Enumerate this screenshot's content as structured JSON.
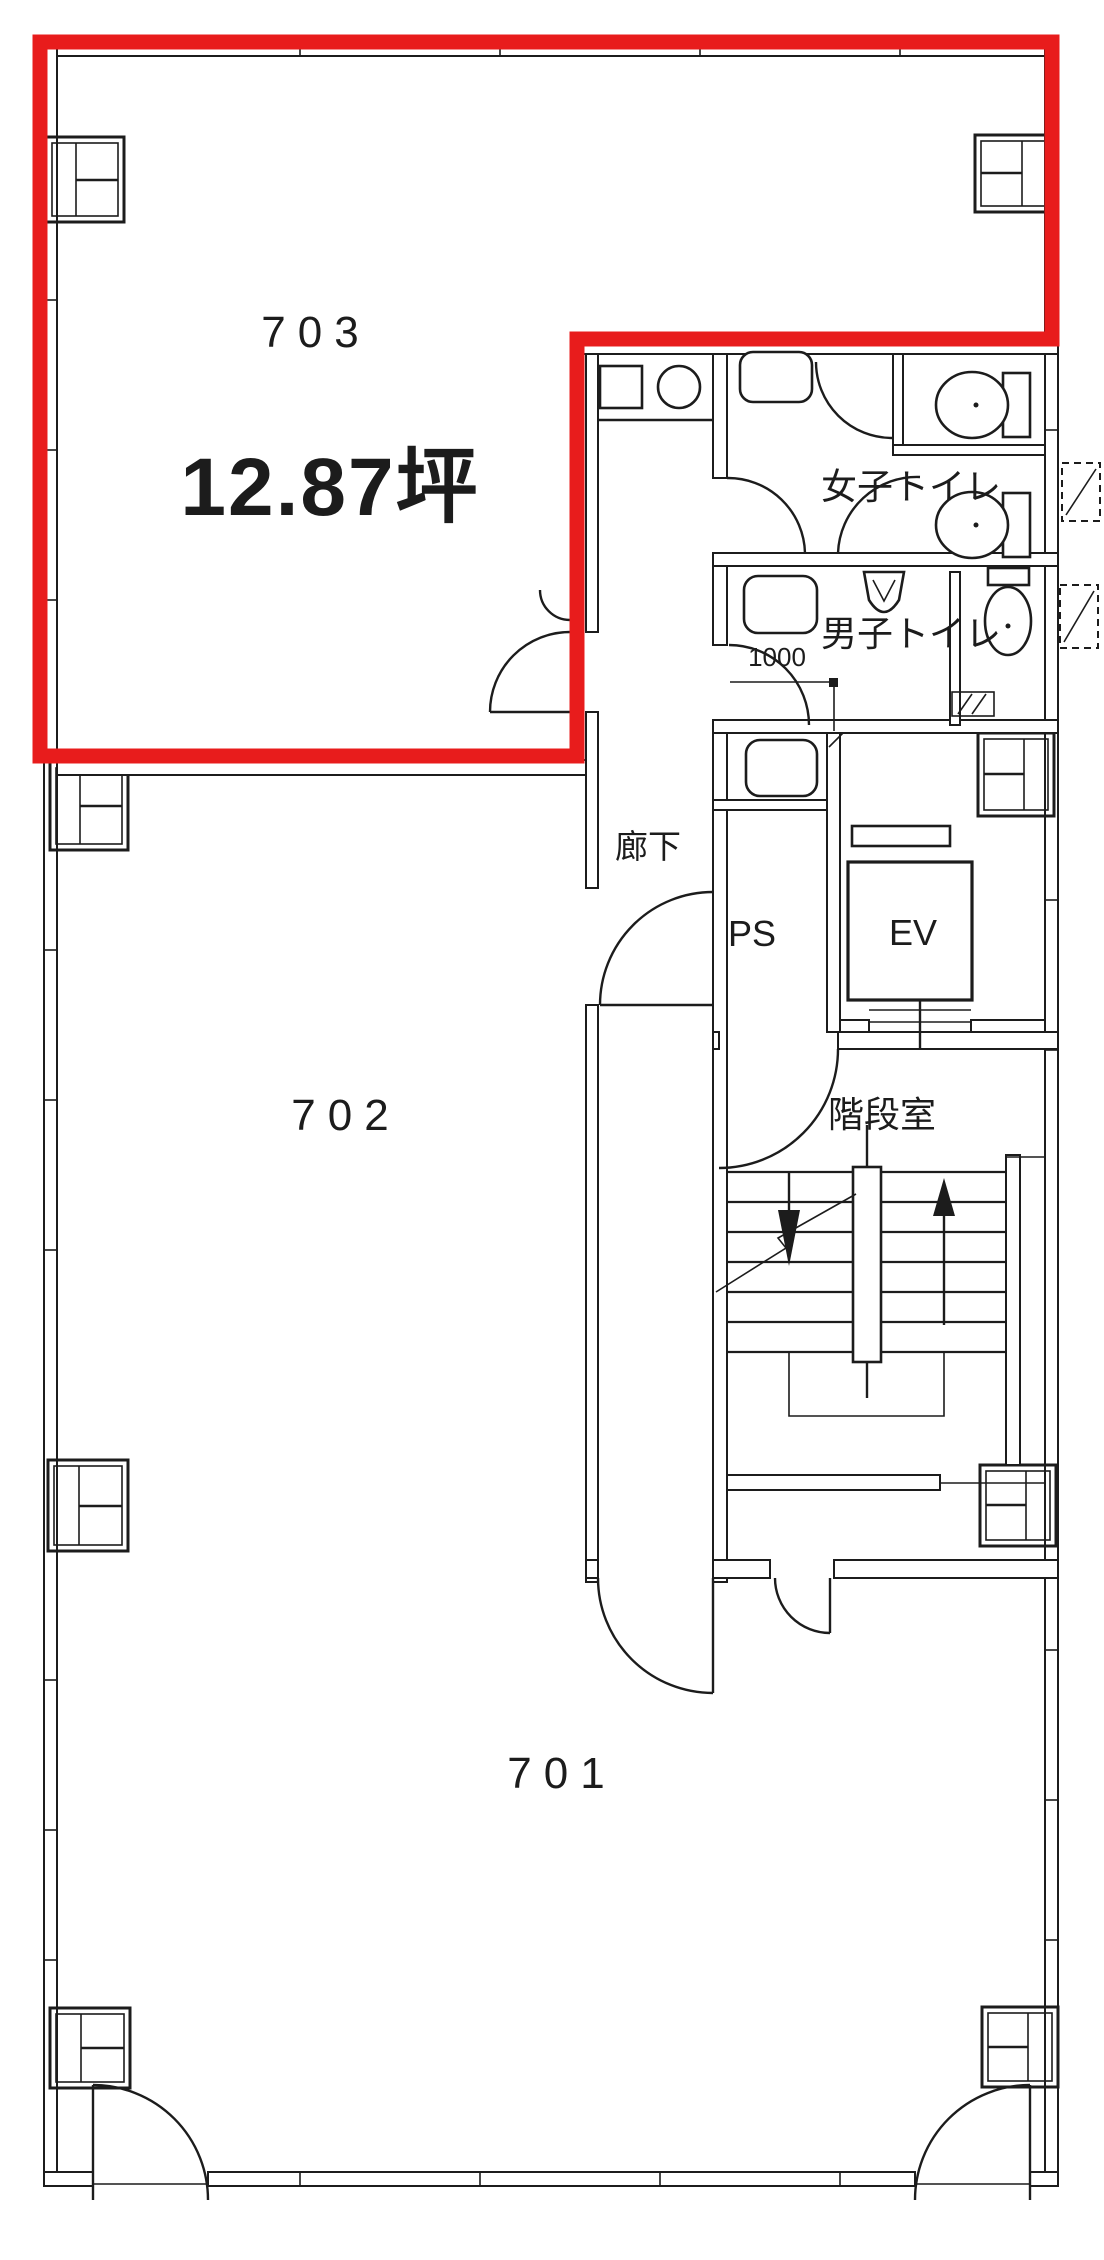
{
  "floor_plan": {
    "type": "building-floor-plan",
    "highlight": {
      "room": "703",
      "color": "#e81c1c"
    },
    "line_color": "#1c1c1c",
    "background": "#ffffff",
    "rooms": [
      {
        "label": "703",
        "area": "12.87坪",
        "highlighted": true
      },
      {
        "label": "702",
        "highlighted": false
      },
      {
        "label": "701",
        "highlighted": false
      }
    ],
    "labels": {
      "room_703": "703",
      "room_703_area": "12.87坪",
      "room_702": "702",
      "room_701": "701",
      "corridor": "廊下",
      "pipe_space": "PS",
      "elevator": "EV",
      "stair_room": "階段室",
      "womens_toilet": "女子トイレ",
      "mens_toilet": "男子トイレ",
      "dim_1000": "1000"
    }
  }
}
